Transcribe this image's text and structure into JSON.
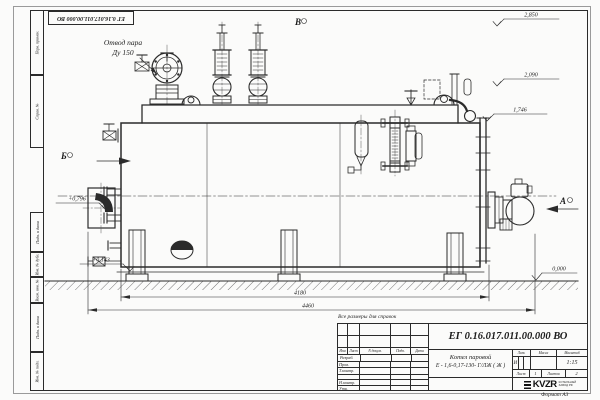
{
  "sheet": {
    "stamp_top": "ЕГ 0.16.017.011.00.000  ВО",
    "note": "Все размеры для справок",
    "format_label": "Формат  А3",
    "frame_left_top": [
      "Перв. примен.",
      "Справ. №"
    ],
    "frame_left_bottom": [
      "Подп. и дата",
      "Инв. № дубл.",
      "Взам. инв. №",
      "Подп. и дата",
      "Инв. № подл."
    ]
  },
  "drawing": {
    "callout_line1": "Отвод пара",
    "callout_line2": "Ду 150",
    "view_top": "В",
    "view_left": "Б",
    "view_right": "А",
    "elevations": {
      "top1": "2,850",
      "top2": "2,090",
      "top3": "1,746",
      "ground": "0,000",
      "left1": "+0,796",
      "left2": "+0,143"
    },
    "dim_inner": "4180",
    "dim_overall": "4460"
  },
  "titleblock": {
    "doc_number": "ЕГ 0.16.017.011.00.000  ВО",
    "name_line1": "Котел паровой",
    "name_line2": "Е - 1,6-0,17-130- Г/ЛЖ ( Ж )",
    "col_izm": "Изм",
    "col_list": "Лист",
    "col_docnum": "N докум.",
    "col_podp": "Подп.",
    "col_data": "Дата",
    "row_razrab": "Разраб.",
    "row_prov": "Пров.",
    "row_tkontr": "Т.контр.",
    "row_nkontr": "Н.контр.",
    "row_utv": "Утв.",
    "lit_label": "Лит.",
    "mass_label": "Масса",
    "scale_label": "Масштаб",
    "lit_value": "И",
    "scale_value": "1:15",
    "sheet_label": "Лист",
    "sheet_value": "1",
    "sheets_label": "Листов",
    "sheets_value": "2",
    "logo_text": "KVZR",
    "logo_sub1": "КОТЕЛЬНЫЙ",
    "logo_sub2": "ЗАВОД РФ"
  }
}
